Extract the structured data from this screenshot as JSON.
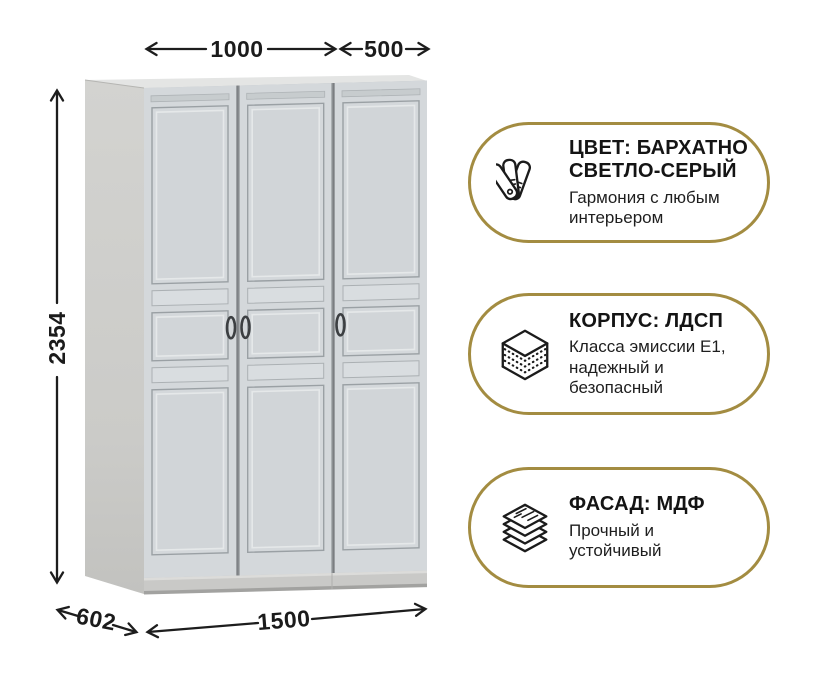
{
  "colors": {
    "accent_gold": "#A38C41",
    "text_dark": "#1b1b1b",
    "arrow": "#1d1d1d",
    "door_face": "#d4d8db",
    "side_panel": "#cdcecb"
  },
  "dimensions": {
    "top_width_left": "1000",
    "top_width_right": "500",
    "height": "2354",
    "depth": "602",
    "total_width": "1500"
  },
  "badges": [
    {
      "icon": "color-swatches-icon",
      "title_lines": [
        "ЦВЕТ: БАРХАТНО",
        "СВЕТЛО-СЕРЫЙ"
      ],
      "subtitle_lines": [
        "Гармония с любым",
        "интерьером"
      ]
    },
    {
      "icon": "chipboard-layers-icon",
      "title_lines": [
        "КОРПУС: ЛДСП"
      ],
      "subtitle_lines": [
        "Класса эмиссии E1,",
        "надежный и",
        "безопасный"
      ]
    },
    {
      "icon": "mdf-sheets-icon",
      "title_lines": [
        "ФАСАД: МДФ"
      ],
      "subtitle_lines": [
        "Прочный и",
        "устойчивый"
      ]
    }
  ]
}
